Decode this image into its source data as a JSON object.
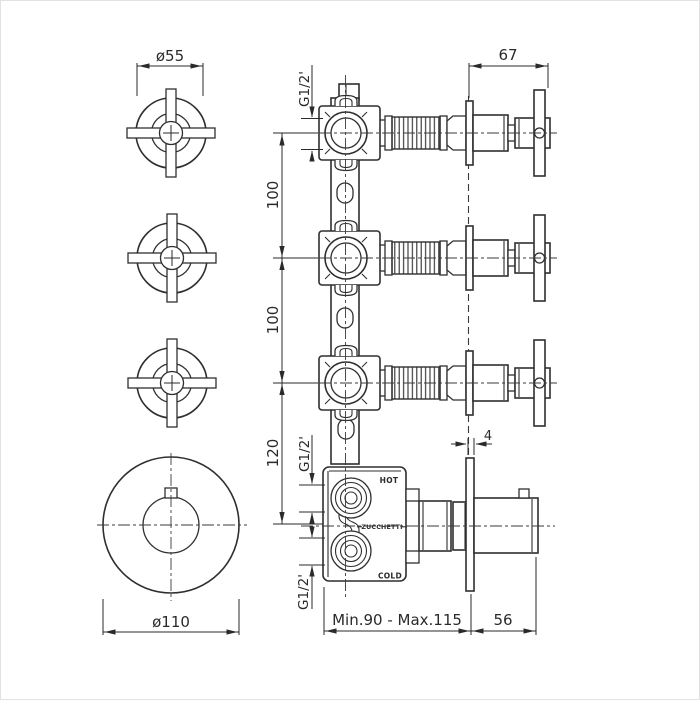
{
  "meta": {
    "background_color": "#ffffff",
    "line_color": "#2f2f2f",
    "drawing_type": "thermostatic shower mixer installation diagram"
  },
  "front_view": {
    "handle_dia_label": "ø55",
    "plate_dia_label": "ø110"
  },
  "side_view": {
    "proj_label": "67",
    "spacing_labels": [
      "100",
      "100",
      "120"
    ],
    "thread_label": "G1/2'",
    "plate_thickness_label": "4",
    "depth_range_label": "Min.90 - Max.115",
    "knob_proj_label": "56",
    "hot_label": "HOT",
    "cold_label": "COLD",
    "brand_label": "ZUCCHETTI"
  }
}
